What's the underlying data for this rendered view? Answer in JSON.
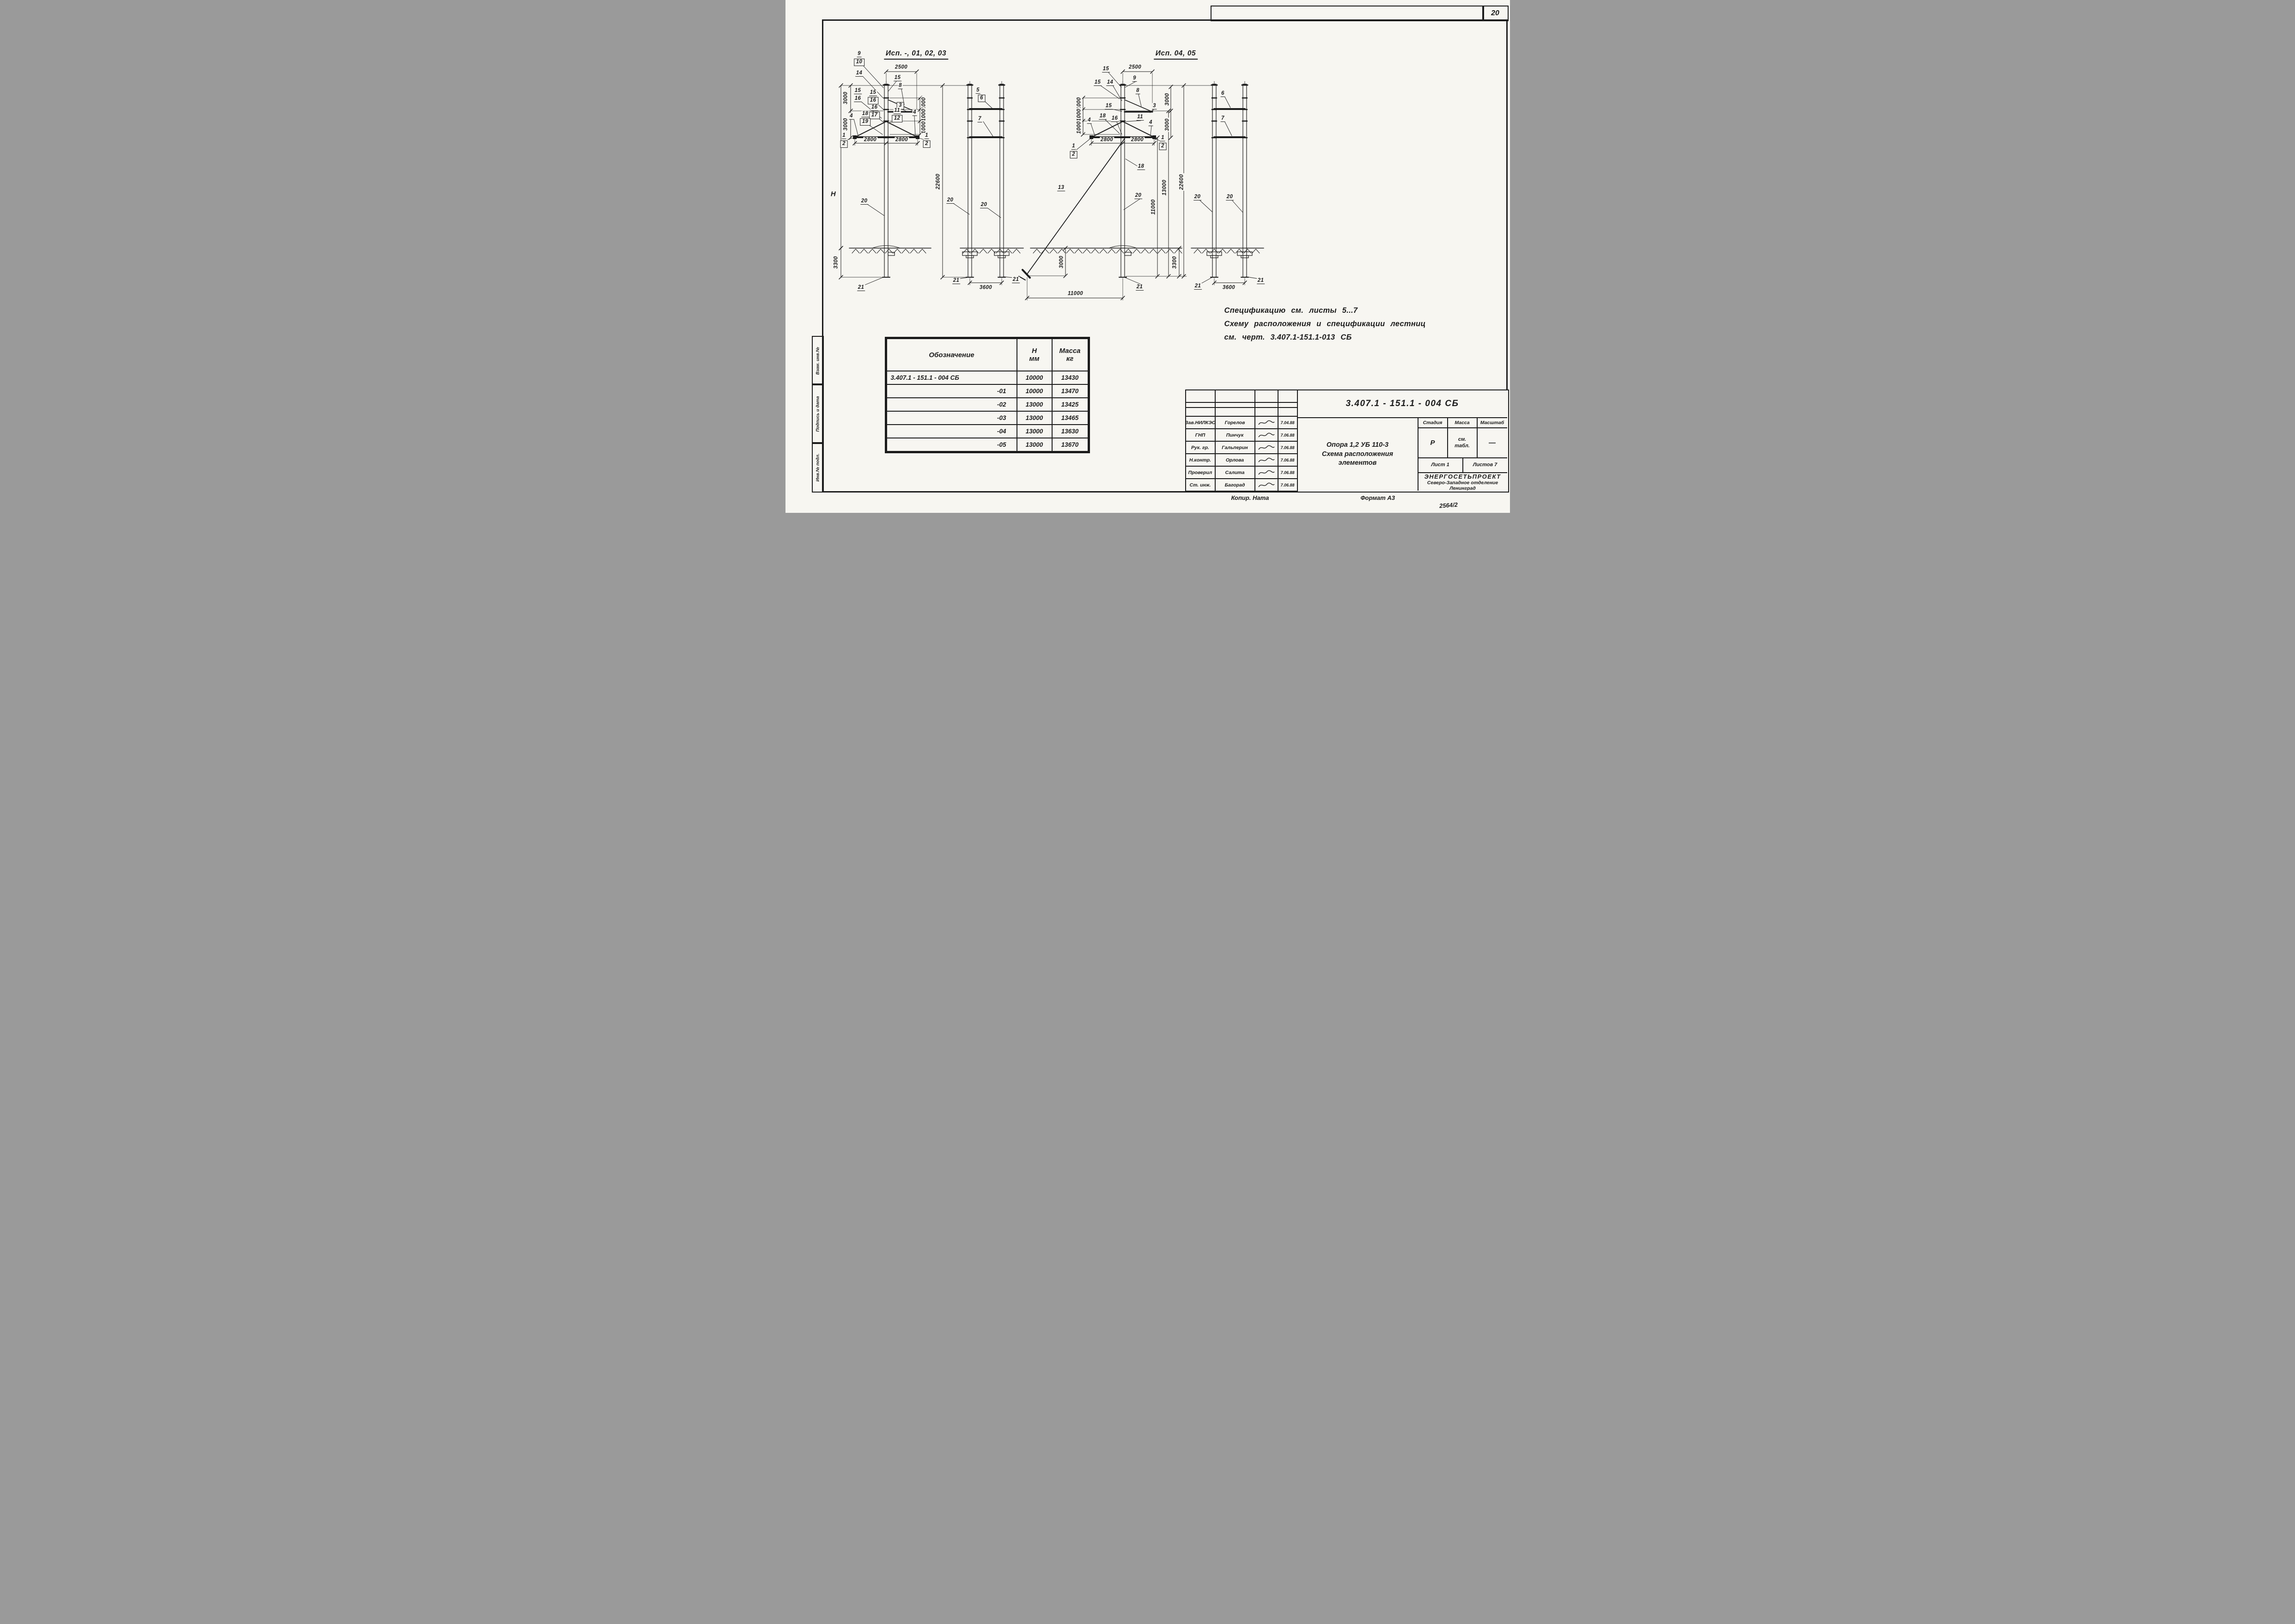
{
  "sheet": {
    "page_number": "20",
    "format_note": "Формат А3",
    "copier_note": "Копир. Ната",
    "archive_number": "2564/2"
  },
  "views": {
    "group1_title": "Исп. -, 01, 02, 03",
    "group2_title": "Исп. 04, 05"
  },
  "notes": {
    "line1": "Спецификацию см. листы 5...7",
    "line2": "Схему расположения и спецификации лестниц",
    "line3": "см. черт. 3.407.1-151.1-013 СБ"
  },
  "spec_table": {
    "col_designation": "Обозначение",
    "col_h": "Н",
    "col_h_unit": "мм",
    "col_mass": "Масса",
    "col_mass_unit": "кг",
    "rows": [
      {
        "designation": "3.407.1 - 151.1 - 004 СБ",
        "h": "10000",
        "mass": "13430"
      },
      {
        "designation": "-01",
        "h": "10000",
        "mass": "13470"
      },
      {
        "designation": "-02",
        "h": "13000",
        "mass": "13425"
      },
      {
        "designation": "-03",
        "h": "13000",
        "mass": "13465"
      },
      {
        "designation": "-04",
        "h": "13000",
        "mass": "13630"
      },
      {
        "designation": "-05",
        "h": "13000",
        "mass": "13670"
      }
    ]
  },
  "title_block": {
    "doc_number": "3.407.1 - 151.1 - 004 СБ",
    "product_title": "Опора 1,2 УБ 110-3",
    "drawing_title_line1": "Схема расположения",
    "drawing_title_line2": "элементов",
    "stage_label": "Стадия",
    "mass_label": "Масса",
    "scale_label": "Масштаб",
    "stage_value": "Р",
    "mass_value": "см. табл.",
    "scale_value": "—",
    "sheet_label": "Лист",
    "sheet_value": "1",
    "sheets_label": "Листов",
    "sheets_value": "7",
    "organization": "ЭНЕРГОСЕТЬПРОЕКТ",
    "org_branch": "Северо-Западное отделение",
    "org_city": "Ленинград",
    "personnel": [
      {
        "role": "Зав.НИЛКЭС",
        "name": "Горелов",
        "date": "7.04.88"
      },
      {
        "role": "ГНП",
        "name": "Пинчук",
        "date": "7.06.88"
      },
      {
        "role": "Рук. гр.",
        "name": "Гальперин",
        "date": "7.06.88"
      },
      {
        "role": "Н.контр.",
        "name": "Орлова",
        "date": "7.06.88"
      },
      {
        "role": "Проверил",
        "name": "Салита",
        "date": "7.06.88"
      },
      {
        "role": "Ст. инж.",
        "name": "Багорад",
        "date": "7.06.88"
      }
    ]
  },
  "margin_labels": {
    "box1": "Взам. инв.№",
    "box2": "Подпись и дата",
    "box3": "Инв.№ подл."
  },
  "ann": {
    "g1f_c9": "9",
    "g1f_c10": "10",
    "g1f_c14": "14",
    "g1f_d2500": "2500",
    "g1f_c15a": "15",
    "g1f_c15b": "15",
    "g1f_c16b": "16",
    "g1f_c15c": "15",
    "g1f_c16c": "16",
    "g1f_c16d": "16",
    "g1f_c17": "17",
    "g1f_c8": "8",
    "g1f_c3": "3",
    "g1f_c11": "11",
    "g1f_c12": "12",
    "g1f_c18": "18",
    "g1f_c19": "19",
    "g1f_c4l": "4",
    "g1f_c4r": "4",
    "g1f_d1000a": "1000",
    "g1f_d1000b": "1000",
    "g1f_d1000c": "1000",
    "g1f_d3000a": "3000",
    "g1f_d3000b": "3000",
    "g1f_dH": "H",
    "g1f_d2800l": "2800",
    "g1f_d2800r": "2800",
    "g1f_c1l": "1",
    "g1f_c2l": "2",
    "g1f_c1r": "1",
    "g1f_c2r": "2",
    "g1f_c20": "20",
    "g1f_d3300": "3300",
    "g1f_c21": "21",
    "g1s_d22600": "22600",
    "g1s_c5": "5",
    "g1s_c6": "6",
    "g1s_c7": "7",
    "g1s_c20a": "20",
    "g1s_c20b": "20",
    "g1s_c21a": "21",
    "g1s_c21b": "21",
    "g1s_d3600": "3600",
    "g2f_c15a": "15",
    "g2f_d2500": "2500",
    "g2f_c15b": "15",
    "g2f_c14": "14",
    "g2f_c9": "9",
    "g2f_c8": "8",
    "g2f_c3": "3",
    "g2f_c15c": "15",
    "g2f_c11": "11",
    "g2f_c4l": "4",
    "g2f_c4r": "4",
    "g2f_c18a": "18",
    "g2f_c16": "16",
    "g2f_d1000a": "1000",
    "g2f_d1000b": "1000",
    "g2f_d1000c": "1000",
    "g2f_d3000a": "3000",
    "g2f_d3000b": "3000",
    "g2f_d2800l": "2800",
    "g2f_d2800r": "2800",
    "g2f_c1l": "1",
    "g2f_c2l": "2",
    "g2f_c1r": "1",
    "g2f_c2r": "2",
    "g2f_c18b": "18",
    "g2f_c13": "13",
    "g2f_c20": "20",
    "g2f_d11000v": "11000",
    "g2f_d13000": "13000",
    "g2f_d22600": "22600",
    "g2f_d3000c": "3000",
    "g2f_d3300": "3300",
    "g2f_c21": "21",
    "g2f_d11000h": "11000",
    "g2s_c6": "6",
    "g2s_c7": "7",
    "g2s_c20a": "20",
    "g2s_c20b": "20",
    "g2s_c21a": "21",
    "g2s_c21b": "21",
    "g2s_d3600": "3600"
  }
}
